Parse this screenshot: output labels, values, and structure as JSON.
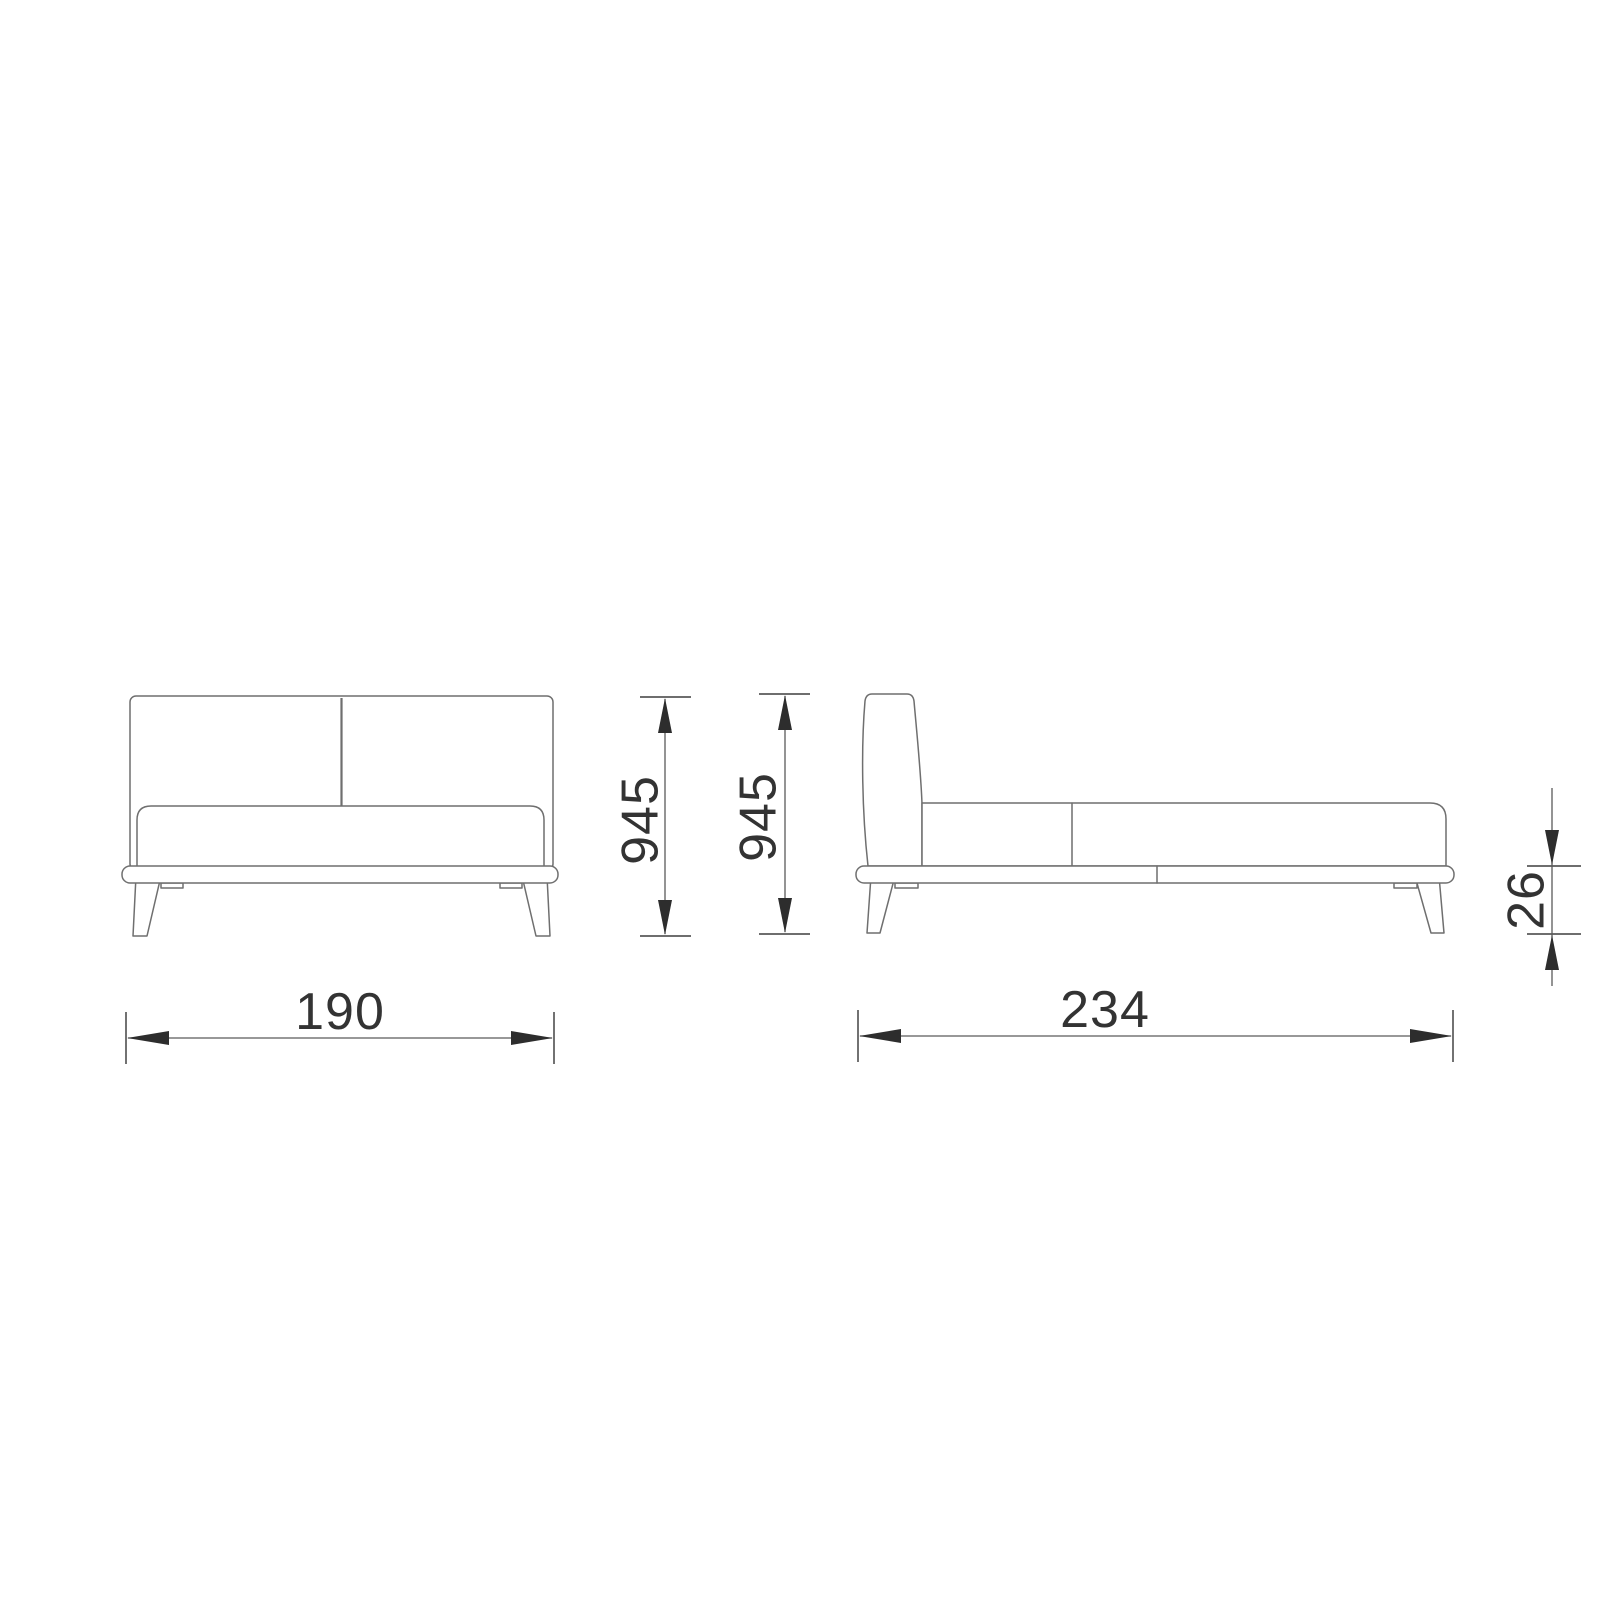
{
  "page": {
    "background": "#ffffff"
  },
  "diagram": {
    "subject": "bed-technical-drawing",
    "views": {
      "front": "front-elevation",
      "side": "side-elevation"
    },
    "colors": {
      "outline": "#6f6f6f",
      "dimension_line": "#5a5a5a",
      "arrow": "#2d2d2d",
      "label_text": "#333333"
    },
    "dimensions": {
      "front_height": "945",
      "side_height": "945",
      "front_width": "190",
      "side_length": "234",
      "base_height": "26"
    }
  }
}
